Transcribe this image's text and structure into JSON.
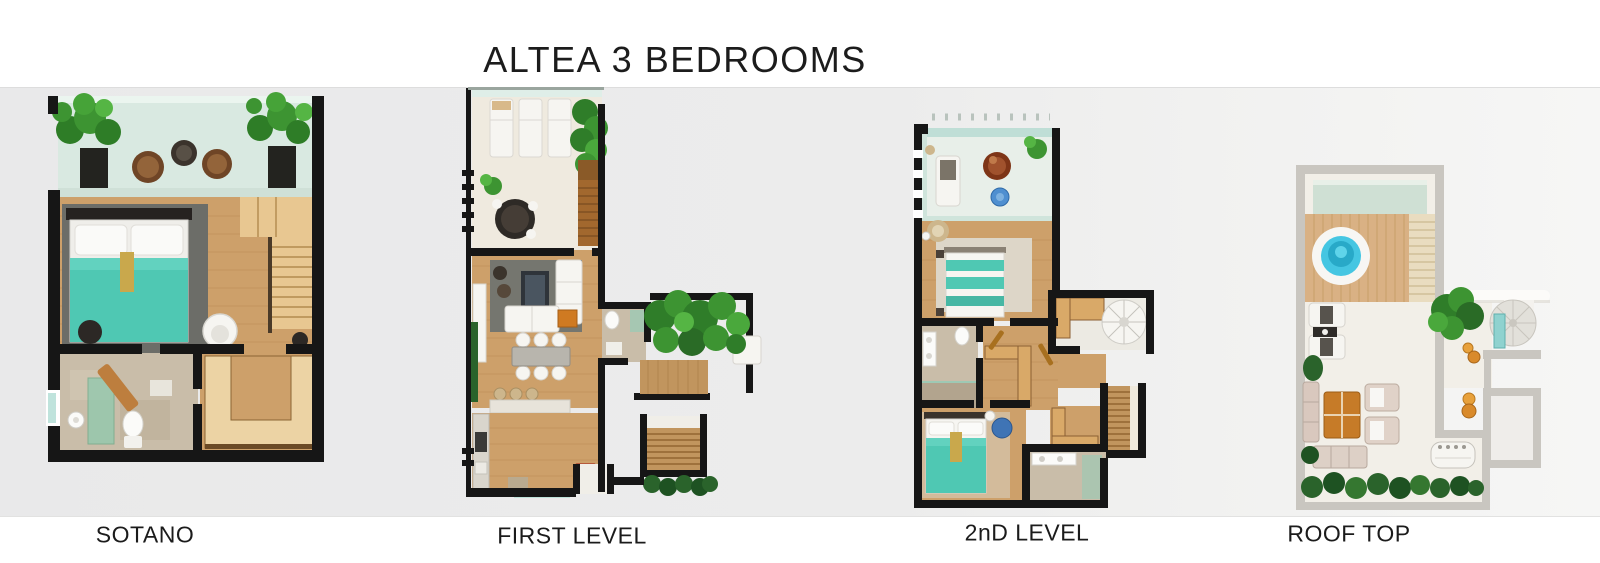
{
  "title": "ALTEA 3 BEDROOMS",
  "plans": [
    {
      "id": "sotano",
      "label": "SOTANO"
    },
    {
      "id": "first-level",
      "label": "FIRST LEVEL"
    },
    {
      "id": "second-level",
      "label": "2nD LEVEL"
    },
    {
      "id": "roof-top",
      "label": "ROOF TOP"
    }
  ],
  "colors": {
    "wall": "#161616",
    "wallgray": "#c9c6c0",
    "wood": "#cda06a",
    "woodlight": "#e8c791",
    "teal": "#4fc8b3",
    "plant": "#3d9432",
    "plantdark": "#2a632b",
    "pool": "#45c6e2",
    "glass": "#d9e9e1",
    "stone": "#c9bda9",
    "rug": "#6c6d68",
    "red": "#d41f17",
    "white": "#f6f5f1",
    "floor": "#f2efe8",
    "cream": "#efeadf",
    "background": "#ececec"
  }
}
